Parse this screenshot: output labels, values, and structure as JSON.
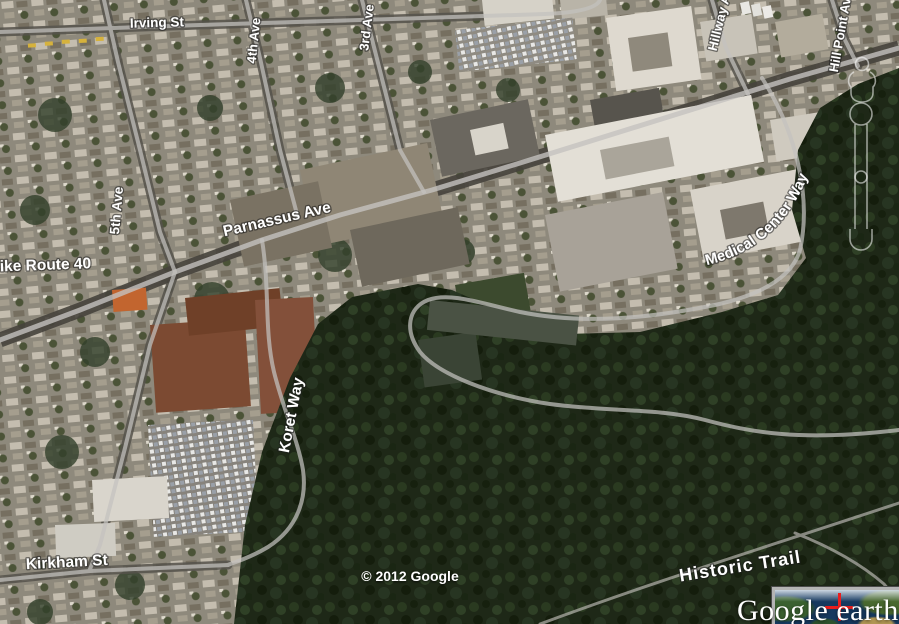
{
  "map_labels": {
    "irving_st": "Irving St",
    "third_ave": "3rd Ave",
    "fourth_ave": "4th Ave",
    "fifth_ave": "5th Ave",
    "hillway_ave": "Hillway Ave",
    "hill_point_ave": "Hill Point Ave",
    "bike_route_40": "Bike Route 40",
    "parnassus_ave": "Parnassus Ave",
    "medical_center_way": "Medical Center Way",
    "koret_way": "Koret Way",
    "kirkham_st": "Kirkham St",
    "historic_trail": "Historic Trail"
  },
  "attribution": {
    "copyright": "© 2012 Google",
    "watermark": "Google earth"
  },
  "overview_map": {
    "crosshair_color": "#e81e1e"
  },
  "icons": {
    "pegman": "pegman-outline",
    "zoom_slider": "zoom-slider-outline",
    "crosshair": "red-crosshair"
  },
  "colors": {
    "label_text": "#ffffff",
    "road_overlay": "#c4c2bf",
    "forest": "#1e2817"
  }
}
